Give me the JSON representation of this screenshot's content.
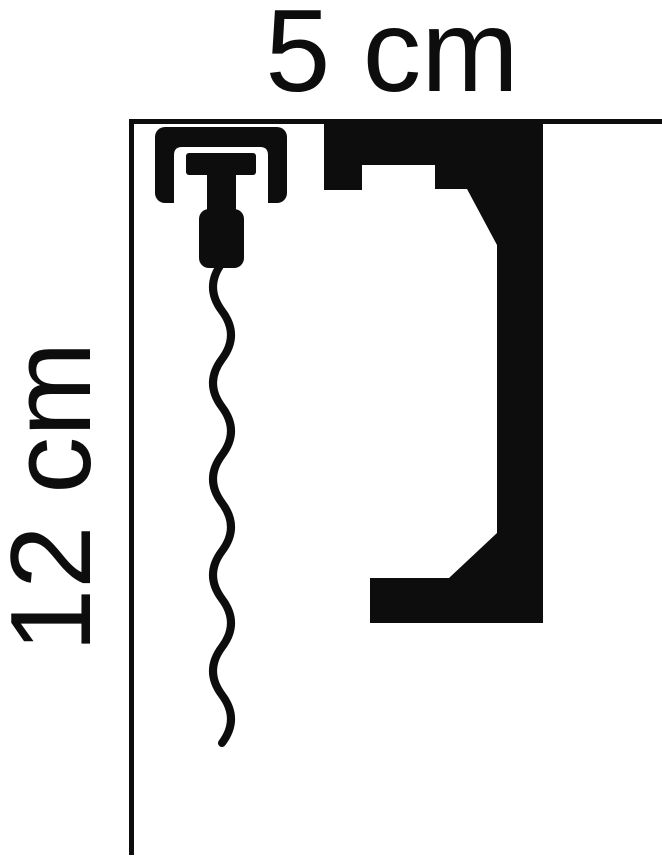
{
  "figure": {
    "kind": "technical dimension diagram",
    "subject": "cornice profile cross-section with curtain track"
  },
  "labels": {
    "width_dimension": "5 cm",
    "height_dimension": "12 cm"
  },
  "colors": {
    "ink": "#0d0d0d",
    "background": "#ffffff"
  },
  "icons": {
    "curtain_track": "curtain-track-icon",
    "curtain_glider": "curtain-glider-icon",
    "curtain_wave": "curtain-wave-icon"
  }
}
